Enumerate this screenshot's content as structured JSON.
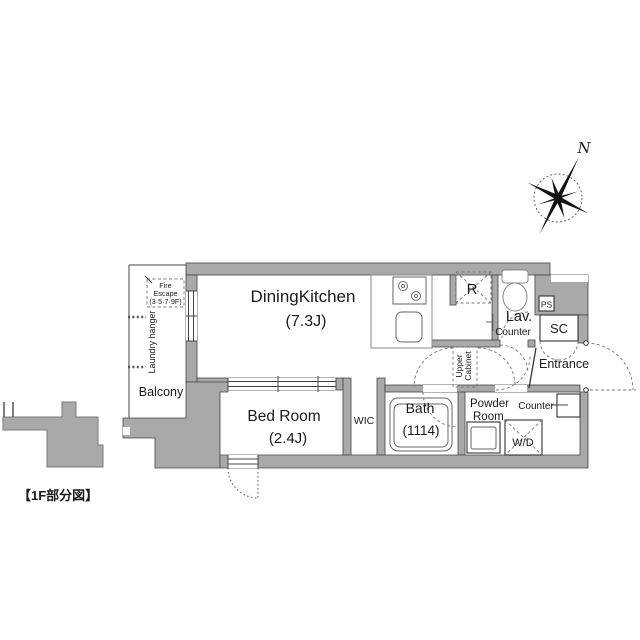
{
  "caption": "【1F部分図】",
  "compass": {
    "north_label": "N"
  },
  "rooms": {
    "dining_kitchen": {
      "name": "DiningKitchen",
      "size": "(7.3J)"
    },
    "bed_room": {
      "name": "Bed Room",
      "size": "(2.4J)"
    },
    "bath": {
      "name": "Bath",
      "size": "(1114)"
    },
    "wic": {
      "name": "WIC"
    },
    "powder_room": {
      "name_line1": "Powder",
      "name_line2": "Room"
    },
    "lavatory": {
      "name": "Lav."
    },
    "entrance": {
      "name": "Entrance"
    },
    "balcony": {
      "name": "Balcony"
    },
    "shoe_closet": {
      "name": "SC"
    },
    "pipe_space": {
      "name": "PS"
    },
    "refrigerator_space": {
      "name": "R"
    }
  },
  "features": {
    "lav_counter": "Counter",
    "powder_counter": "Counter",
    "washer_dryer": "W/D",
    "upper_cabinet_line1": "Upper",
    "upper_cabinet_line2": "Cabinet",
    "laundry_hanger": "Laundry hanger",
    "fire_escape_line1": "Fire",
    "fire_escape_line2": "Escape",
    "fire_escape_line3": "(3·5·7·9F)"
  },
  "colors": {
    "wall_fill": "#a9a9a9",
    "wall_outline": "#454545",
    "dashed_line": "#777777",
    "text": "#1a1a1a"
  }
}
